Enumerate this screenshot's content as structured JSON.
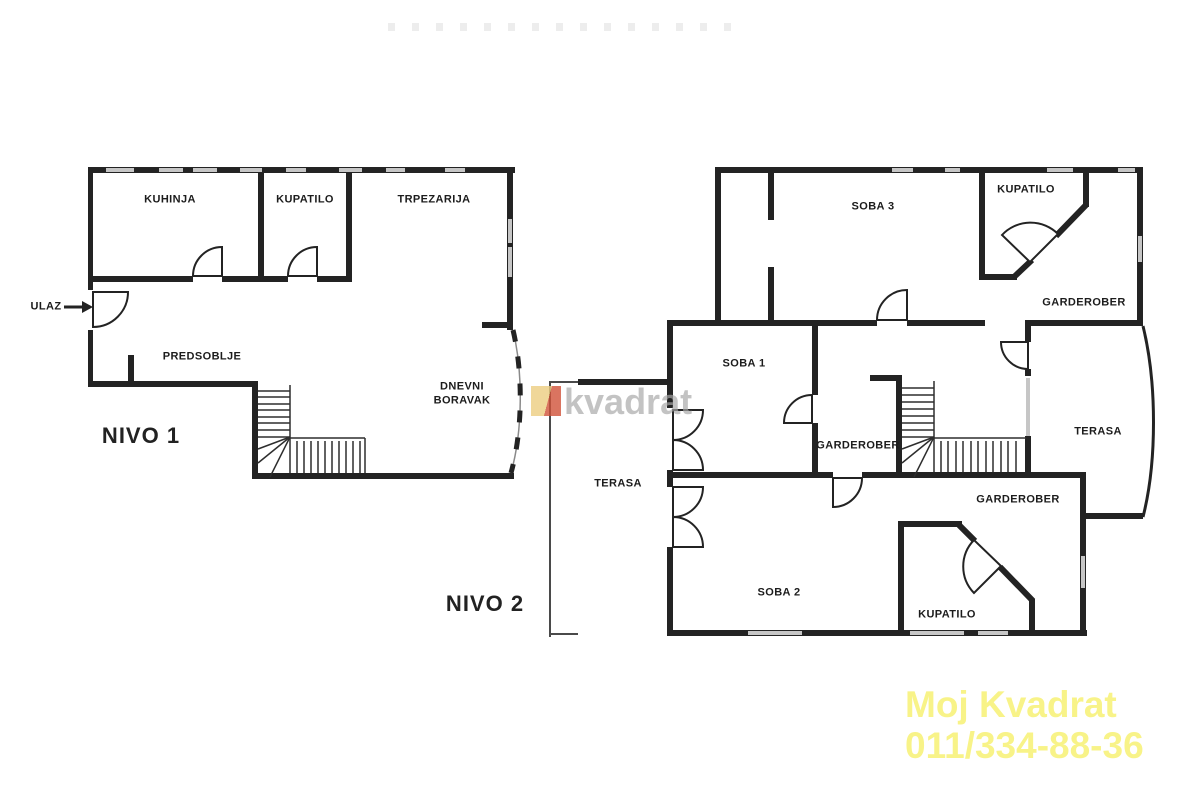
{
  "page": {
    "background": "#ffffff"
  },
  "levels": {
    "level1": {
      "title": "NIVO 1",
      "rooms": {
        "kuhinja": "KUHINJA",
        "kupatilo": "KUPATILO",
        "trpezarija": "TRPEZARIJA",
        "predsoblje": "PREDSOBLJE",
        "dnevni_line1": "DNEVNI",
        "dnevni_line2": "BORAVAK",
        "ulaz": "ULAZ"
      }
    },
    "level2": {
      "title": "NIVO 2",
      "rooms": {
        "soba1": "SOBA 1",
        "soba2": "SOBA 2",
        "soba3": "SOBA 3",
        "kupatilo_upper": "KUPATILO",
        "kupatilo_lower": "KUPATILO",
        "garderober_upper": "GARDEROBER",
        "garderober_middle": "GARDEROBER",
        "garderober_lower": "GARDEROBER",
        "terasa_left": "TERASA",
        "terasa_right": "TERASA"
      }
    }
  },
  "watermark": {
    "logo_text": "kvadrat"
  },
  "branding": {
    "line1": "Moj Kvadrat",
    "line2": "011/334-88-36"
  },
  "colors": {
    "wall": "#232323",
    "window": "#c6c6c6",
    "label": "#1c1c1c",
    "watermark_gray": "#a8a8a8",
    "branding_yellow": "#f8f388",
    "logo_yellow": "#eccd80",
    "logo_red": "#d05138"
  }
}
